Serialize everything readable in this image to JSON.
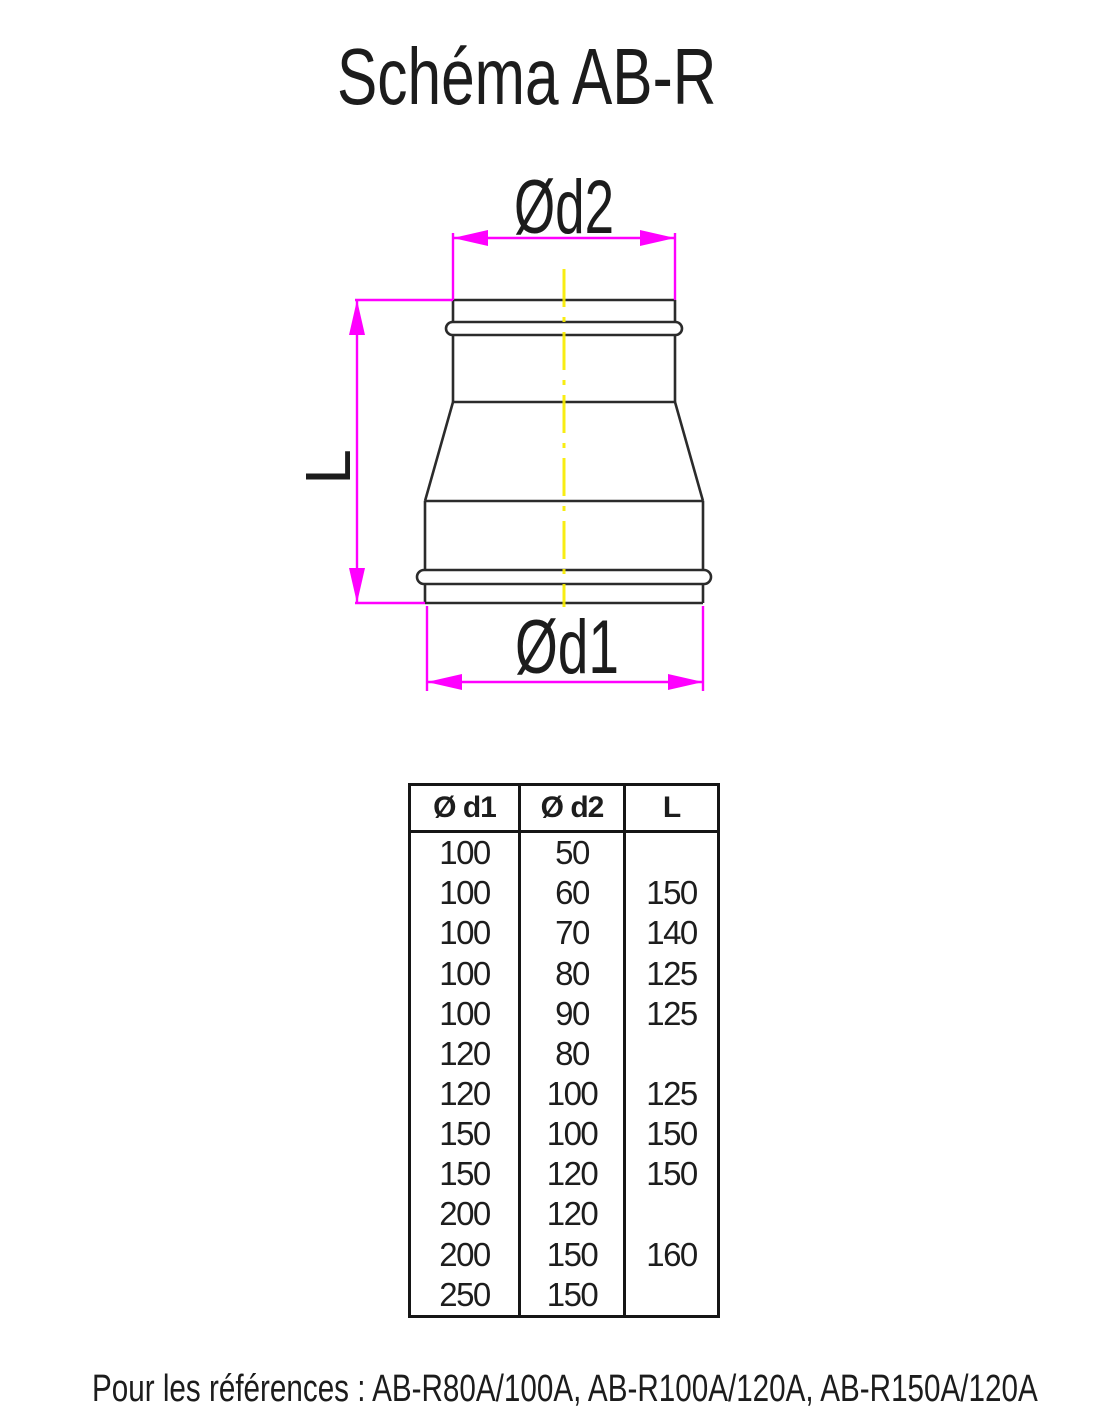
{
  "title": "Schéma AB-R",
  "diagram": {
    "labels": {
      "d2": "Ød2",
      "d1": "Ød1",
      "length": "L"
    },
    "colors": {
      "dimension": "#ff00ff",
      "outline": "#2b2b2b",
      "centerline": "#f8ec00"
    }
  },
  "table": {
    "headers": [
      "Ø d1",
      "Ø d2",
      "L"
    ],
    "rows": [
      [
        "100",
        "50",
        ""
      ],
      [
        "100",
        "60",
        "150"
      ],
      [
        "100",
        "70",
        "140"
      ],
      [
        "100",
        "80",
        "125"
      ],
      [
        "100",
        "90",
        "125"
      ],
      [
        "120",
        "80",
        ""
      ],
      [
        "120",
        "100",
        "125"
      ],
      [
        "150",
        "100",
        "150"
      ],
      [
        "150",
        "120",
        "150"
      ],
      [
        "200",
        "120",
        ""
      ],
      [
        "200",
        "150",
        "160"
      ],
      [
        "250",
        "150",
        ""
      ]
    ]
  },
  "footer": "Pour les références : AB-R80A/100A, AB-R100A/120A, AB-R150A/120A"
}
